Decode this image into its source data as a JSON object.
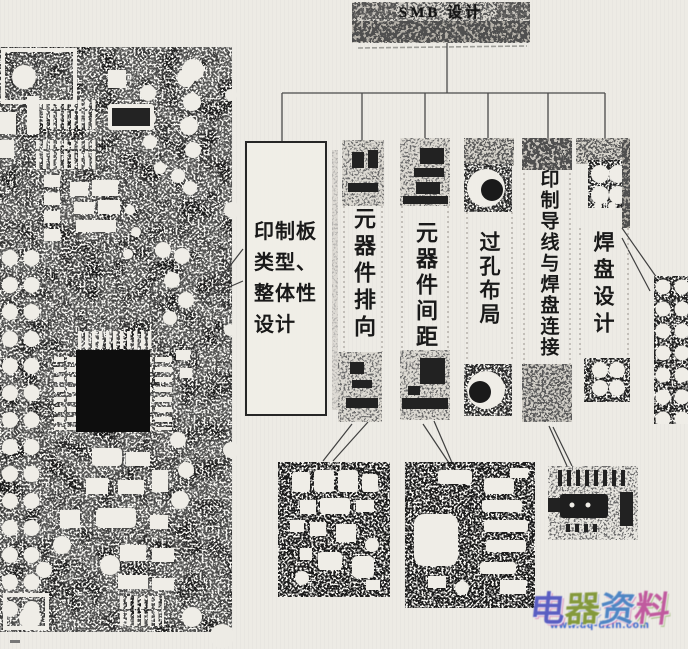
{
  "tree": {
    "root_label": "SMB 设计",
    "branches": [
      {
        "id": "pcb-type-overall-design",
        "label": "印制板类型、整体性设计"
      },
      {
        "id": "component-orientation",
        "label": "元器件排向"
      },
      {
        "id": "component-spacing",
        "label": "元器件间距"
      },
      {
        "id": "via-layout",
        "label": "过孔布局"
      },
      {
        "id": "trace-pad-connection",
        "label": "印制导线与焊盘连接"
      },
      {
        "id": "pad-design",
        "label": "焊盘设计"
      }
    ]
  },
  "figures": {
    "main_pcb": "smb-circuit-board-photo",
    "orientation_top_patch": "component-photo-strip",
    "spacing_top_patch": "component-photo-strip",
    "via_photo": "via-hole-photo",
    "pad_array_photo": "solder-pad-array-photo",
    "orientation_example": "component-orientation-example-photo",
    "spacing_example": "component-spacing-example-photo",
    "connection_example": "trace-pad-connection-example-photo",
    "right_pad_array": "solder-pad-array-photo"
  },
  "watermark": {
    "text": "电器资料",
    "chars": [
      "电",
      "器",
      "资",
      "料"
    ],
    "url": "www.dq-dzin.com",
    "colors": [
      "#5a5ec2",
      "#84993c",
      "#4f86c4",
      "#c05a9e"
    ]
  }
}
